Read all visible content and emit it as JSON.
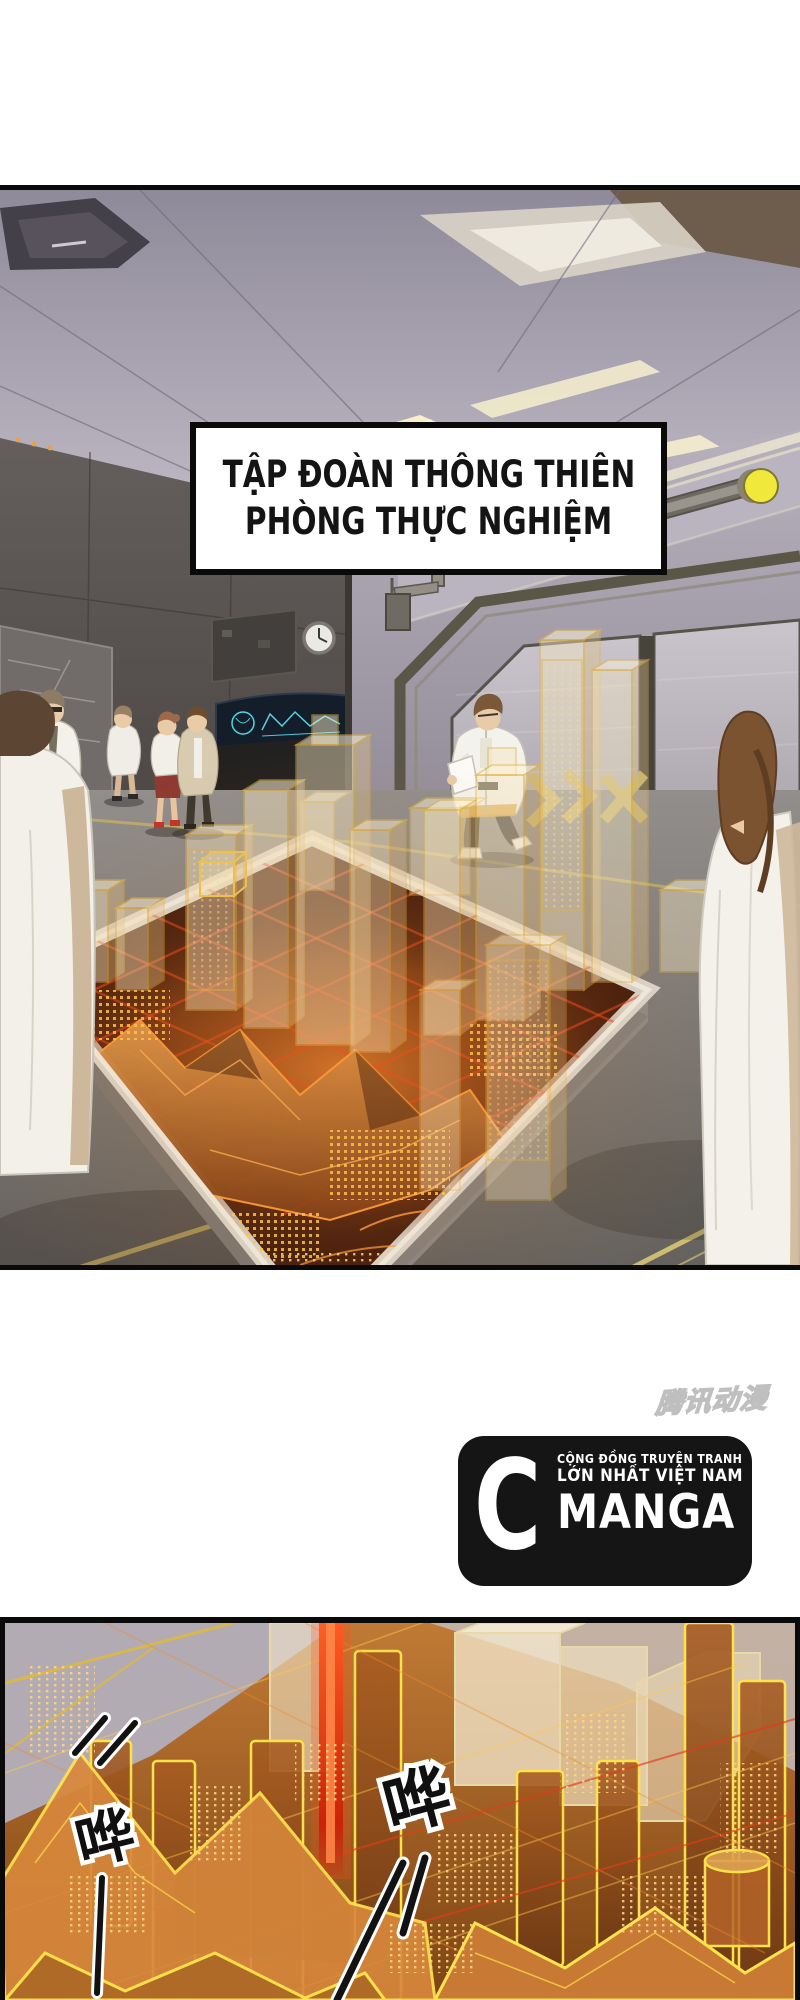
{
  "page": {
    "width": 800,
    "height": 2000,
    "background": "#ffffff"
  },
  "panel1": {
    "caption_box": {
      "line1": "TẬP ĐOÀN THÔNG THIÊN",
      "line2": "PHÒNG THỰC NGHIỆM",
      "text_color": "#141414",
      "bg": "#ffffff",
      "border": "#000000"
    },
    "scene_elements": [
      "ceiling-vent",
      "ceiling-light-strip",
      "status-lights",
      "wall-clock",
      "notice-panel",
      "control-screen",
      "blast-door",
      "gold-chevrons",
      "scientists-in-lab-coats",
      "hologram-city-table"
    ],
    "palette": {
      "ceiling": "#a49eae",
      "door_wall": "#b3aebb",
      "left_wall": "#5b5553",
      "floor": "#85817f",
      "door": "#c2bdc4",
      "signal_yellow": "#f2e93e",
      "hologram_gold": "#ffd45e",
      "hologram_orange": "#d8813c",
      "table_base": "#4a1f0e",
      "grid_red": "#e8512a",
      "lab_coat": "#f4f2ec"
    }
  },
  "watermark": {
    "text": "腾讯动漫",
    "color": "#c9c9c9"
  },
  "logo": {
    "letter": "C",
    "brand": "MANGA",
    "tagline_line1": "CỘNG ĐỒNG TRUYỆN TRANH",
    "tagline_line2": "LỚN NHẤT VIỆT NAM",
    "bg": "#151515",
    "fg": "#ffffff"
  },
  "panel2": {
    "sfx1": "哗",
    "sfx2": "哗",
    "palette": {
      "beam_red": "#e8350f",
      "contour_yellow": "#ffe44e",
      "city_orange": "#c07a35",
      "shadow_brown": "#5a2f12",
      "wall_gray": "#b3abb4"
    }
  }
}
